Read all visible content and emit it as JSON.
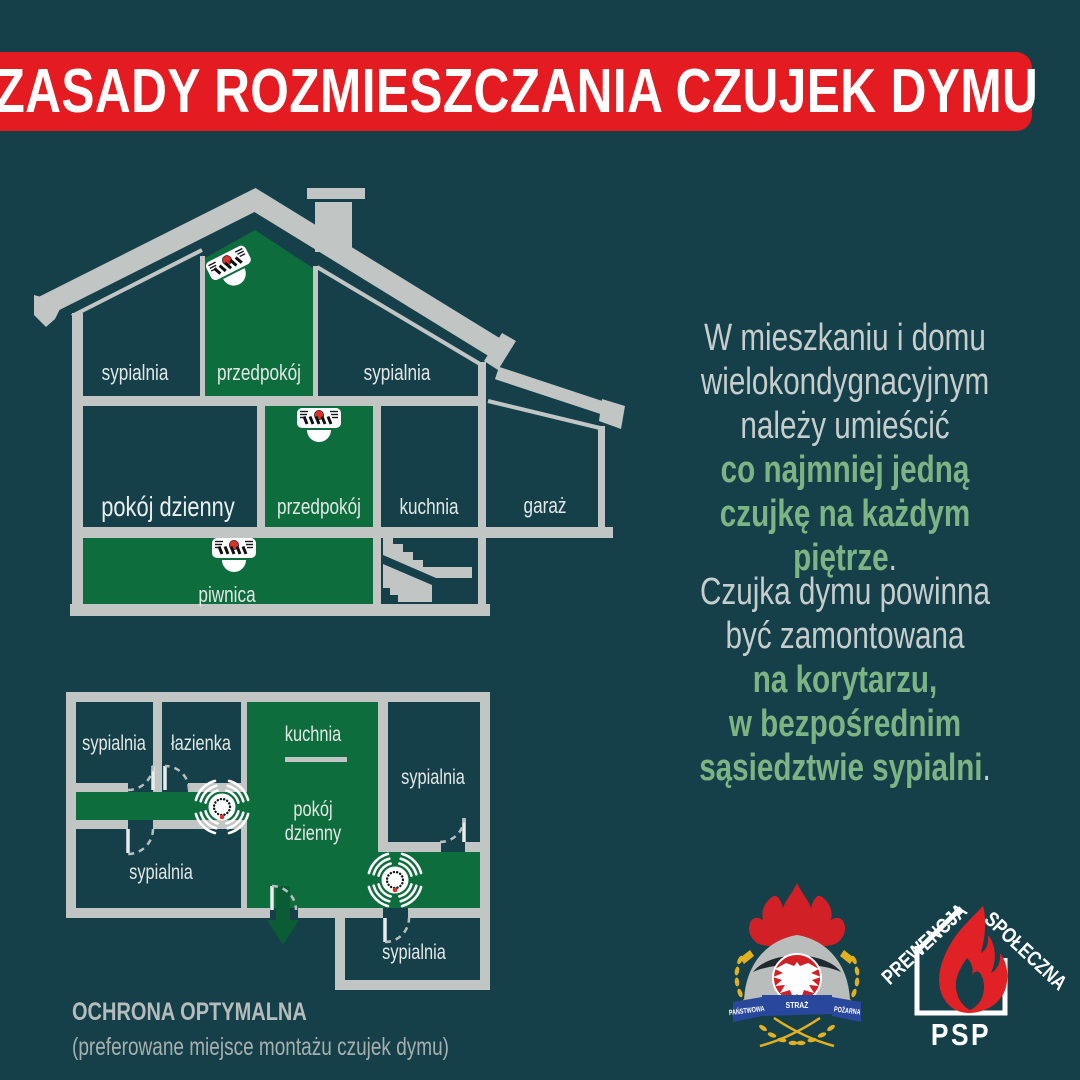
{
  "banner": {
    "title": "ZASADY ROZMIESZCZANIA CZUJEK DYMU"
  },
  "colors": {
    "background": "#164049",
    "room_green": "#0e6d3d",
    "arrow_green": "#0a5c34",
    "structure_gray": "#c1c5c4",
    "label_light": "#e2e7e6",
    "body_text_gray": "#c6cdcd",
    "accent_green_text": "#7cb483",
    "banner_red": "#e41b21",
    "logo_red": "#d22027",
    "detector_led_red": "#d8322a",
    "ribbon_blue": "#27489c",
    "laurel_gold": "#e3b11f"
  },
  "house_section": {
    "attic_bedroom_left": "sypialnia",
    "attic_hallway": "przedpokój",
    "attic_bedroom_right": "sypialnia",
    "living_room": "pokój dzienny",
    "hallway": "przedpokój",
    "kitchen": "kuchnia",
    "garage": "garaż",
    "basement": "piwnica"
  },
  "floor_plan": {
    "bedroom_top_left": "sypialnia",
    "bathroom": "łazienka",
    "kitchen": "kuchnia",
    "bedroom_right": "sypialnia",
    "living_room_line1": "pokój",
    "living_room_line2": "dzienny",
    "bedroom_bottom_left": "sypialnia",
    "bedroom_bottom_right": "sypialnia"
  },
  "caption": {
    "title": "OCHRONA OPTYMALNA",
    "subtitle": "(preferowane miejsce montażu czujek dymu)"
  },
  "right_text": {
    "block1": {
      "line1": "W mieszkaniu i domu",
      "line2": "wielokondygnacyjnym",
      "line3": "należy umieścić",
      "line4": "co najmniej jedną",
      "line5": "czujkę na każdym piętrze",
      "line5_suffix": "."
    },
    "block2": {
      "line1": "Czujka dymu powinna",
      "line2": "być zamontowana",
      "line3": "na korytarzu,",
      "line4": "w bezpośrednim",
      "line5": "sąsiedztwie sypialni",
      "line5_suffix": "."
    }
  },
  "logos": {
    "fire_service_crest": {
      "ribbon_left": "PAŃSTWOWA",
      "ribbon_center": "STRAŻ",
      "ribbon_right": "POŻARNA"
    },
    "psp_prevention": {
      "arc_left": "PREWENCJA",
      "arc_right": "SPOŁECZNA",
      "name": "PSP"
    }
  }
}
